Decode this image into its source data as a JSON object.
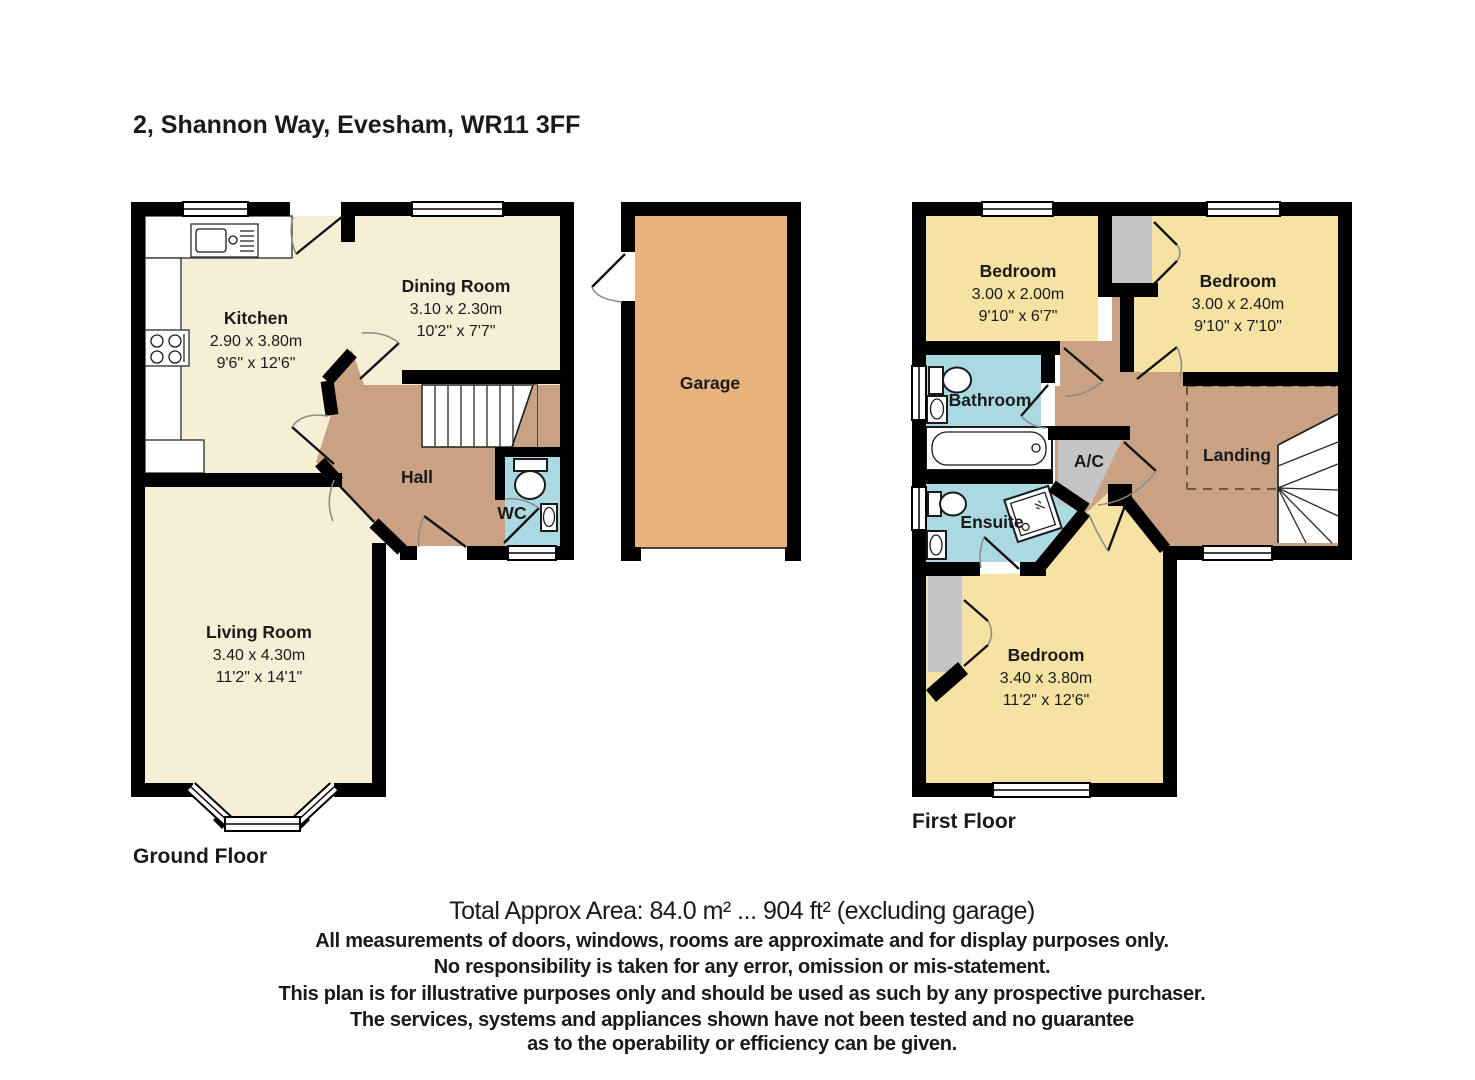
{
  "title": "2, Shannon Way, Evesham, WR11 3FF",
  "colors": {
    "wall": "#000000",
    "cream": "#F7EFD5",
    "yellow": "#F6E2A2",
    "brown": "#C9A284",
    "blue": "#ABD9E1",
    "orange": "#E9B37E",
    "grey": "#C4C4C4",
    "text": "#1A1A1A"
  },
  "ground_floor": {
    "label": "Ground Floor",
    "rooms": {
      "kitchen": {
        "name": "Kitchen",
        "metric": "2.90 x 3.80m",
        "imperial": "9'6\" x 12'6\""
      },
      "dining_room": {
        "name": "Dining Room",
        "metric": "3.10 x 2.30m",
        "imperial": "10'2\" x 7'7\""
      },
      "hall": {
        "name": "Hall"
      },
      "wc": {
        "name": "WC"
      },
      "living_room": {
        "name": "Living Room",
        "metric": "3.40 x 4.30m",
        "imperial": "11'2\" x 14'1\""
      },
      "garage": {
        "name": "Garage"
      }
    }
  },
  "first_floor": {
    "label": "First Floor",
    "rooms": {
      "bedroom_1": {
        "name": "Bedroom",
        "metric": "3.00 x 2.00m",
        "imperial": "9'10\" x 6'7\""
      },
      "bedroom_2": {
        "name": "Bedroom",
        "metric": "3.00 x 2.40m",
        "imperial": "9'10\" x 7'10\""
      },
      "bathroom": {
        "name": "Bathroom"
      },
      "ensuite": {
        "name": "Ensuite"
      },
      "airing_cupboard": {
        "name": "A/C"
      },
      "landing": {
        "name": "Landing"
      },
      "bedroom_3": {
        "name": "Bedroom",
        "metric": "3.40 x 3.80m",
        "imperial": "11'2\" x 12'6\""
      }
    }
  },
  "footer": {
    "area_line": "Total Approx Area: 84.0 m² ... 904 ft² (excluding garage)",
    "disclaimer_lines": [
      "All measurements of doors, windows, rooms are approximate and for display purposes only.",
      "No responsibility is taken for any error, omission or mis-statement.",
      "This plan is for illustrative purposes only and should be used as such by any prospective purchaser.",
      "The services, systems and appliances shown have not been tested and no guarantee",
      "as to the operability or efficiency can be given."
    ]
  },
  "fixtures": [
    "kitchen-sink",
    "kitchen-hob",
    "staircase",
    "wc-toilet",
    "wc-basin",
    "bath",
    "bathroom-toilet",
    "bathroom-basin",
    "ensuite-toilet",
    "ensuite-basin",
    "shower",
    "airing-cupboard",
    "wardrobe",
    "bay-window"
  ]
}
